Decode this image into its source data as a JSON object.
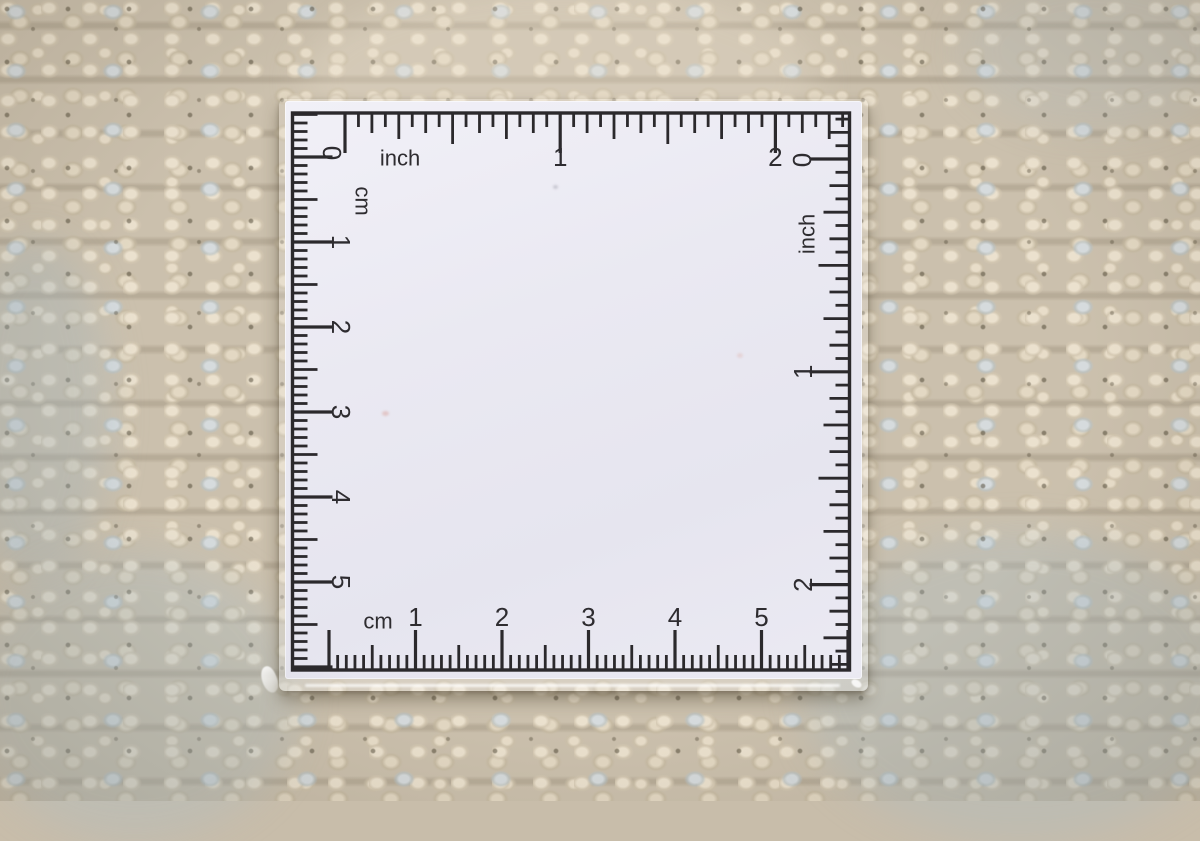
{
  "ruler": {
    "scales": {
      "top": {
        "unit": "inch",
        "zero": "0",
        "numbers": [
          "1",
          "2"
        ]
      },
      "right": {
        "unit": "inch",
        "zero": "0",
        "numbers": [
          "1",
          "2"
        ]
      },
      "left": {
        "unit": "cm",
        "numbers": [
          "1",
          "2",
          "3",
          "4",
          "5"
        ]
      },
      "bottom": {
        "unit": "cm",
        "numbers": [
          "1",
          "2",
          "3",
          "4",
          "5"
        ]
      }
    }
  },
  "colors": {
    "tick": "#2b292c",
    "card": "#eae9f2",
    "fabric_base": "#cbc0ad",
    "fabric_highlight": "#ebe1ce",
    "fabric_blue_fleck": "#d6dbdd",
    "fabric_shadow": "#80745e"
  }
}
